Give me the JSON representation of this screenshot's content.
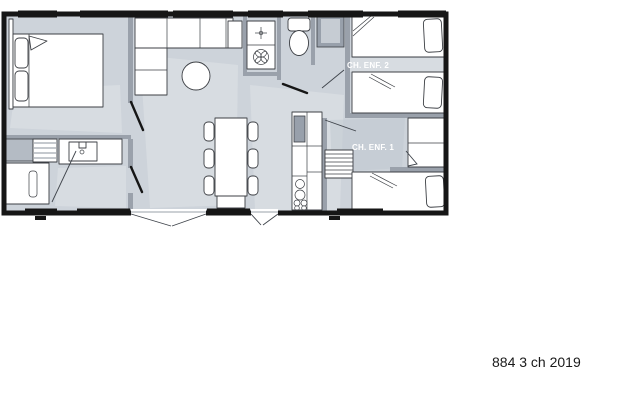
{
  "caption": "884 3 ch 2019",
  "plan": {
    "type": "floor-plan",
    "room_labels": [
      {
        "id": "child-bedroom-2",
        "label": "CH. ENF. 2"
      },
      {
        "id": "child-bedroom-1",
        "label": "CH. ENF. 1"
      }
    ]
  },
  "colors": {
    "wall": "#161616",
    "floor": "#cdd3da",
    "floor_light": "#e0e4e8",
    "floor_shadow": "#bfc7d0",
    "interior_wall": "#9aa1ab",
    "furniture_fill": "#ffffff",
    "furniture_outline": "#3c3f44",
    "cabinet_gray": "#b4bbc4",
    "wardrobe_dark": "#98a0ab",
    "label_text": "#ffffff",
    "caption_text": "#1a1a1a"
  }
}
